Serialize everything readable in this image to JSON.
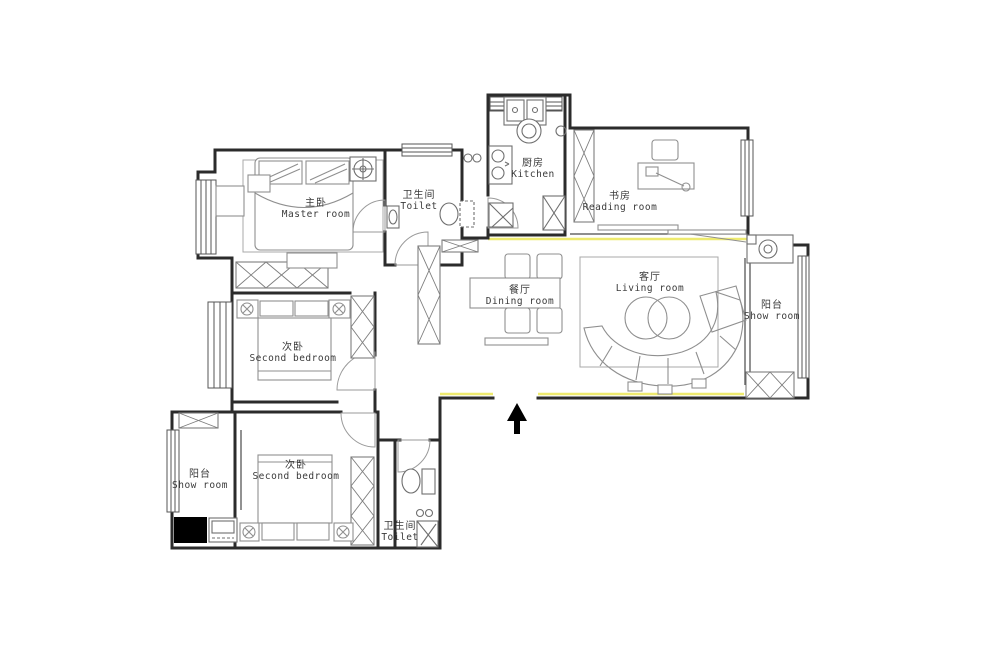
{
  "meta": {
    "drawing_type": "apartment floor plan"
  },
  "colors": {
    "background": "#ffffff",
    "walls": "#2b2b2b",
    "furniture": "#8f8f8f",
    "fixtures": "#6f6f6f",
    "wall_highlight_yellow": "#eeea6e",
    "text": "#3a3a3a",
    "shaft_fill": "#000000",
    "entry_arrow": "#000000"
  },
  "rooms": [
    {
      "id": "master-room",
      "zh": "主卧",
      "en": "Master room"
    },
    {
      "id": "toilet-top",
      "zh": "卫生间",
      "en": "Toilet"
    },
    {
      "id": "kitchen",
      "zh": "厨房",
      "en": "Kitchen"
    },
    {
      "id": "reading-room",
      "zh": "书房",
      "en": "Reading room"
    },
    {
      "id": "dining-room",
      "zh": "餐厅",
      "en": "Dining room"
    },
    {
      "id": "living-room",
      "zh": "客厅",
      "en": "Living room"
    },
    {
      "id": "balcony-right",
      "zh": "阳台",
      "en": "Show room"
    },
    {
      "id": "second-bedroom-middle",
      "zh": "次卧",
      "en": "Second bedroom"
    },
    {
      "id": "second-bedroom-bottom",
      "zh": "次卧",
      "en": "Second bedroom"
    },
    {
      "id": "balcony-left",
      "zh": "阳台",
      "en": "Show room"
    },
    {
      "id": "toilet-bottom",
      "zh": "卫生间",
      "en": "Toilet"
    }
  ],
  "annotations": {
    "entry_arrow": "entry direction (up)"
  }
}
